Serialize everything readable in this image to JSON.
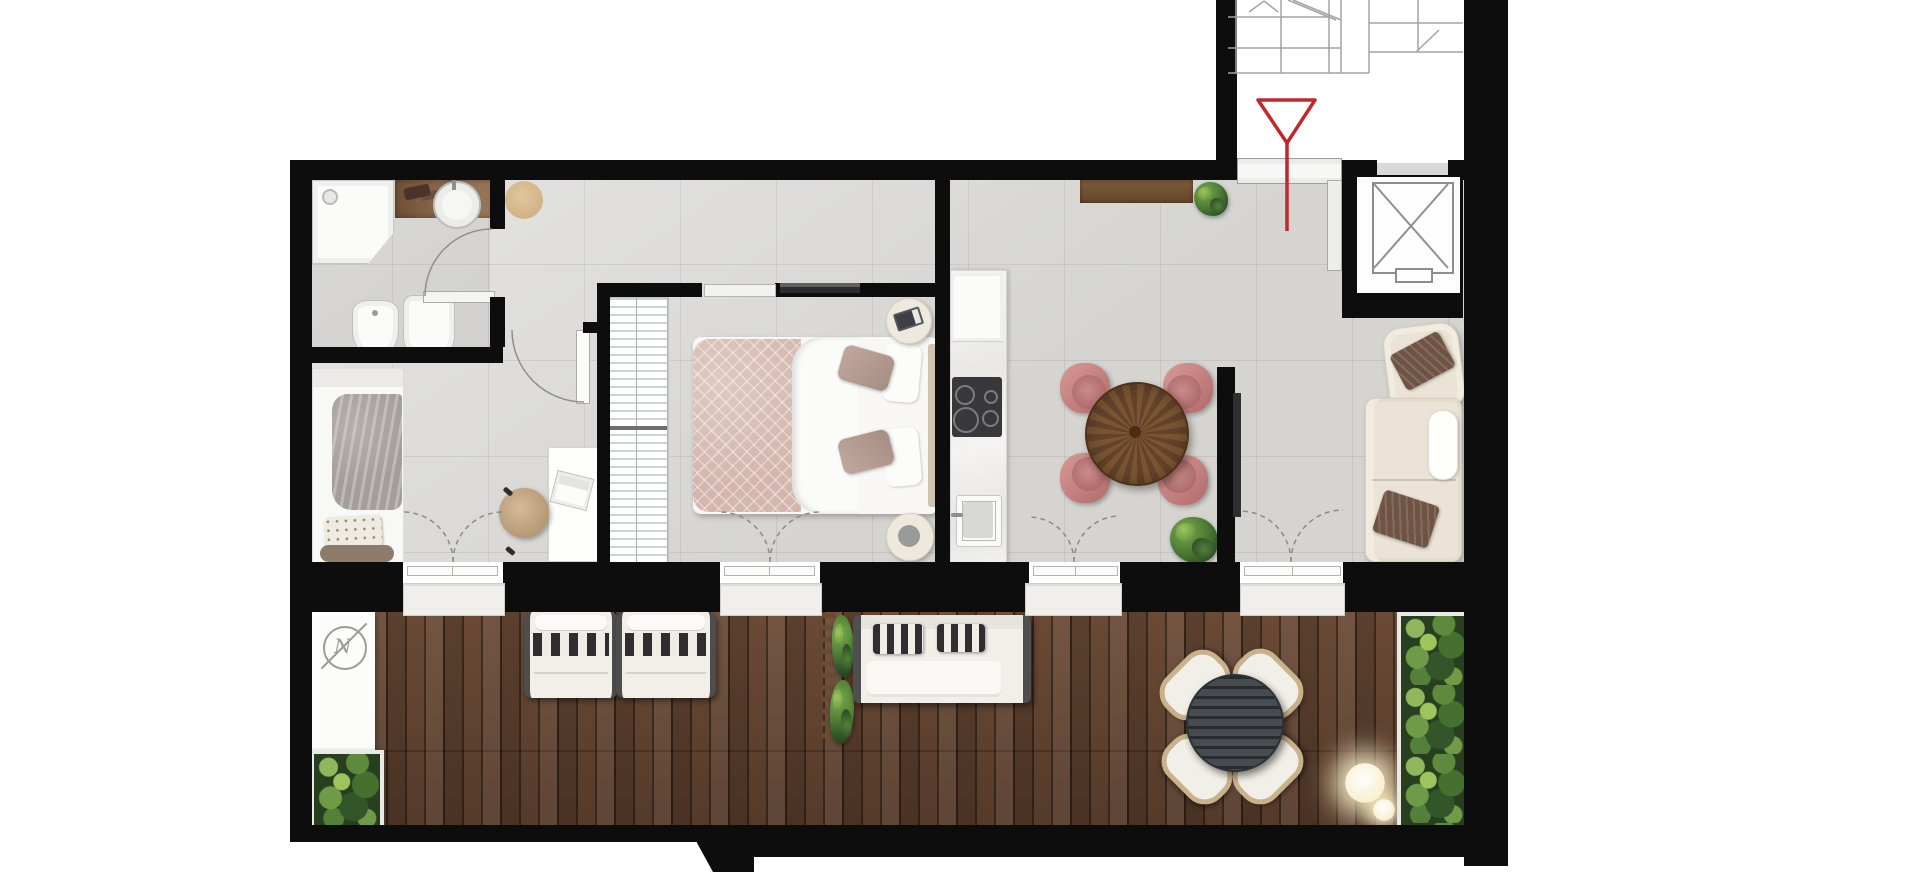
{
  "title": "Apartment floor plan with terrace",
  "compass": {
    "letter": "N"
  },
  "palette": {
    "wall": "#0d0d0d",
    "floor_tile": "#dcdbd8",
    "deck_wood": "#5d4130",
    "entry_red": "#c1272d",
    "sofa_beige": "#ebe4d6",
    "chair_rose": "#c18487",
    "table_walnut": "#7c5634",
    "foliage_green": "#3f6b31",
    "cushion_white": "#f2efe8",
    "pillow_brown": "#6f5445",
    "bed_blush": "#d4b6ac"
  },
  "elements": {
    "stairwell": "Stairwell",
    "entrance_arrow": "Entrance arrow",
    "entrance_door": "Entrance door",
    "elevator": "Elevator",
    "shower": "Shower",
    "vanity_basin": "Vanity basin",
    "toilet": "Toilet",
    "bidet": "Bidet",
    "round_rug": "Round rug",
    "entry_bench": "Entry bench",
    "potted_plant": "Potted plant",
    "single_bed": "Single bed",
    "desk": "Desk",
    "desk_chair": "Desk chair",
    "laptop": "Laptop",
    "bedroom_door": "Bedroom door",
    "bathroom_door": "Bathroom door",
    "sliding_door": "Sliding door",
    "wardrobe": "Wardrobe with hangers",
    "double_bed": "Double bed",
    "nightstand": "Nightstand",
    "wall_tv": "Wall-mounted TV",
    "kitchen_counter": "Kitchen counter",
    "cooktop": "Cooktop",
    "kitchen_sink": "Kitchen sink",
    "dining_table": "Round dining table",
    "dining_chair": "Dining chair",
    "sofa": "Sofa",
    "armchair": "Armchair",
    "french_door": "French door to terrace",
    "terrace": "Terrace deck",
    "north_indicator": "North indicator",
    "planter": "Planter box",
    "sun_lounger": "Sun lounger",
    "green_wall": "Green wall trellis",
    "outdoor_sofa": "Outdoor sofa",
    "outdoor_table": "Outdoor dining table",
    "outdoor_chair": "Outdoor chair",
    "globe_light": "Globe light"
  }
}
